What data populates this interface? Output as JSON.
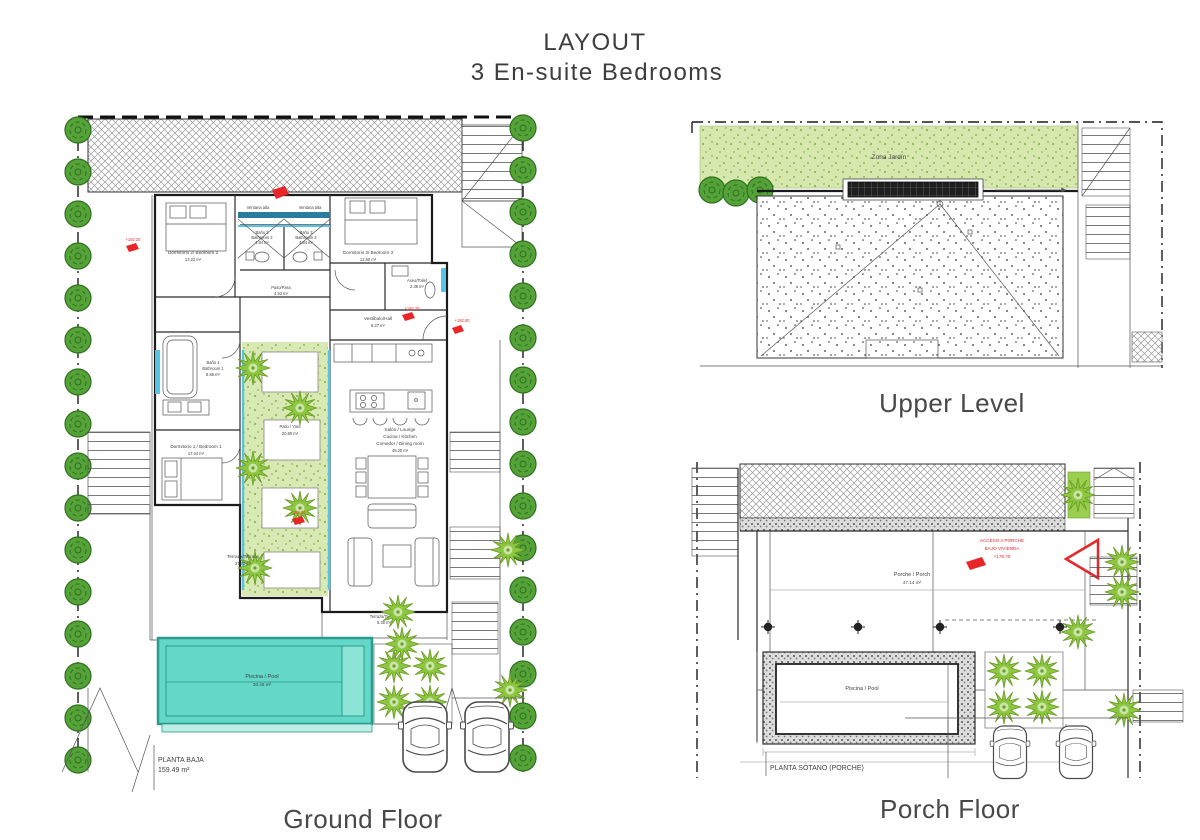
{
  "header": {
    "title": "LAYOUT",
    "subtitle": "3 En-suite Bedrooms"
  },
  "captions": {
    "ground": "Ground Floor",
    "upper": "Upper Level",
    "porch": "Porch Floor"
  },
  "ground": {
    "plan_label": "PLANTA BAJA",
    "plan_area": "159.49 m²",
    "bedroom2_name": "Dormitorio 2/ Bedroom 2",
    "bedroom2_area": "13.22 m²",
    "bath2_name": "Baño 2",
    "bath2_sub": "Bathroom 2",
    "bath2_area": "4.84 m²",
    "bath3_name": "Baño 3",
    "bath3_sub": "Bathroom 3",
    "bath3_area": "4.84 m²",
    "window_note_left": "Ventana alta",
    "window_note_right": "Ventana alta",
    "bedroom3_name": "Dormitorio 3/ Bedroom 3",
    "bedroom3_area": "12.60 m²",
    "pass_name": "Paso/Pass",
    "pass_area": "4.53 m²",
    "toilet_name": "Aseo/Toilet",
    "toilet_area": "2.38 m²",
    "hall_name": "Vestíbulo/Hall",
    "hall_area": "8.27 m²",
    "bath1_name": "Baño 1",
    "bath1_sub": "Bathroom 1",
    "bath1_area": "8.86 m²",
    "bedroom1_name": "Dormitorio 1 / Bedroom 1",
    "bedroom1_area": "17.34 m²",
    "patio_name": "Patio / Yard",
    "patio_area": "20.80 m²",
    "lounge_line1": "Salón / Lounge",
    "lounge_line2": "Cocina / Kitchen",
    "lounge_line3": "Comedor / Dining room",
    "lounge_area": "49.20 m²",
    "terrace_name": "Terraza/Terrace",
    "terrace_area": "37.72 m²",
    "terrace2_name": "Terraza/Terrace",
    "terrace2_area": "5.30 m²",
    "pool_name": "Piscina / Pool",
    "pool_area": "30.45 m²",
    "marker_top": "+182.20",
    "marker_hall": "+182.20",
    "marker_entry": "+182.00",
    "marker_living": "+182.20"
  },
  "upper": {
    "garden_label": "Zona Jardín"
  },
  "porch": {
    "plan_label": "PLANTA SÓTANO (PORCHE)",
    "porch_name": "Porche / Porch",
    "porch_area": "47.14 m²",
    "pool_name": "Piscina / Pool",
    "access_line1": "ACCESO A PORCHE",
    "access_line2": "BAJO VIVIENDA",
    "access_line3": "+179.70"
  },
  "colors": {
    "hedge_green": "#54a238",
    "plant_green": "#8dc63f",
    "lawn_green": "#d9e9b4",
    "pool_teal": "#63d8c8",
    "glazing_blue": "#56c4e4",
    "window_band": "#2a7d9c",
    "marker_red": "#e8262a",
    "hatch_gray": "#9a9a9a",
    "text_dark": "#3f3f3f"
  }
}
